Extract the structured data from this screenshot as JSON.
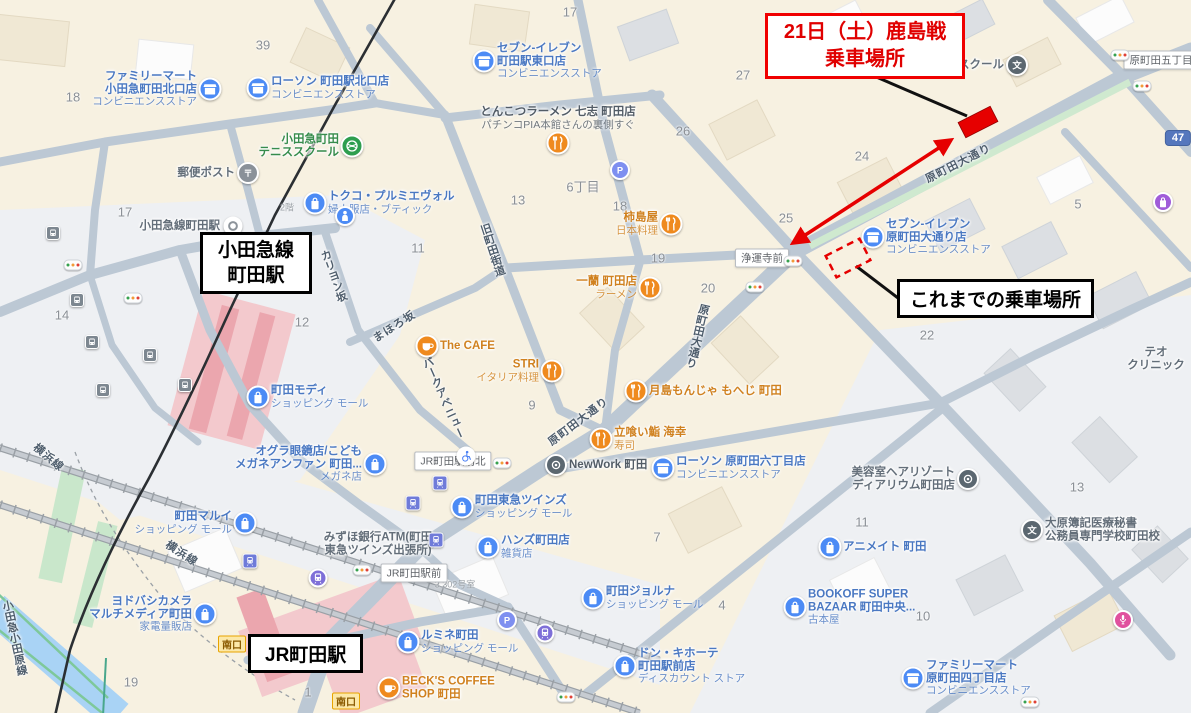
{
  "annotations": {
    "new_boarding": {
      "line1": "21日（土）鹿島戦",
      "line2": "乗車場所"
    },
    "previous_boarding": {
      "label": "これまでの乗車場所"
    },
    "odakyu_box": {
      "line1": "小田急線",
      "line2": "町田駅"
    },
    "jr_box": {
      "label": "JR町田駅"
    },
    "colors": {
      "red": "#e60000",
      "black": "#000000"
    }
  },
  "map": {
    "route_shield": "47",
    "palette": {
      "label_blue": "#4a78c2",
      "label_orange": "#d0811f",
      "label_gray": "#636e79",
      "label_green": "#368c4c",
      "label_dark": "#525c66",
      "poi_blue": "#4c8bf5",
      "poi_orange": "#ef8a1e",
      "poi_green": "#2e9e4f",
      "poi_graymid": "#8a9199",
      "poi_dark": "#5b6770",
      "poi_purple": "#7e6fd8",
      "poi_indigo": "#6f7bd9",
      "poi_busgray": "#7d8790",
      "poi_pblue": "#7e8ff0",
      "poi_pink": "#e0519e",
      "poi_violet": "#a05cd9",
      "poi_white": "#ffffff",
      "road": "#bcc8d4",
      "road_green": "#cfe9cf",
      "water": "#a9d3f5",
      "station_pink": "#f3c9cd",
      "station_pink_dark": "#eba6ae",
      "rail_black": "#2b2f33"
    },
    "intersections": [
      {
        "name": "原町田五丁目",
        "x": 1161,
        "y": 60
      },
      {
        "name": "浄運寺前",
        "x": 762,
        "y": 258
      },
      {
        "name": "JR町田駅前北",
        "x": 453,
        "y": 461
      },
      {
        "name": "JR町田駅前",
        "x": 414,
        "y": 573
      }
    ],
    "gates": {
      "label": "南口",
      "positions": [
        [
          232,
          644
        ],
        [
          346,
          701
        ]
      ]
    },
    "streets": [
      {
        "t": "原町田大通り",
        "x": 958,
        "y": 163,
        "mode": "h",
        "r": -27
      },
      {
        "t": "原町田大通り",
        "x": 697,
        "y": 336,
        "mode": "v",
        "r": 13
      },
      {
        "t": "原町田大通り",
        "x": 578,
        "y": 421,
        "mode": "h",
        "r": -37
      },
      {
        "t": "パークアベニュー",
        "x": 443,
        "y": 398,
        "mode": "v",
        "r": -24
      },
      {
        "t": "まほろ坂",
        "x": 394,
        "y": 326,
        "mode": "h",
        "r": -33
      },
      {
        "t": "旧町田街道",
        "x": 492,
        "y": 250,
        "mode": "v",
        "r": -18
      },
      {
        "t": "カリヨン坂",
        "x": 333,
        "y": 276,
        "mode": "v",
        "r": -20
      },
      {
        "t": "横浜線",
        "x": 49,
        "y": 457,
        "mode": "h",
        "r": 40
      },
      {
        "t": "横浜線",
        "x": 182,
        "y": 553,
        "mode": "h",
        "r": 33
      },
      {
        "t": "小田急小田原線",
        "x": 14,
        "y": 638,
        "mode": "v",
        "r": -12
      }
    ],
    "numbers": [
      {
        "t": "18",
        "x": 73,
        "y": 97
      },
      {
        "t": "39",
        "x": 263,
        "y": 45
      },
      {
        "t": "17",
        "x": 570,
        "y": 12
      },
      {
        "t": "17",
        "x": 125,
        "y": 212
      },
      {
        "t": "27",
        "x": 743,
        "y": 75
      },
      {
        "t": "26",
        "x": 683,
        "y": 131
      },
      {
        "t": "24",
        "x": 862,
        "y": 156
      },
      {
        "t": "25",
        "x": 786,
        "y": 218
      },
      {
        "t": "18",
        "x": 620,
        "y": 206
      },
      {
        "t": "6丁目",
        "x": 583,
        "y": 186
      },
      {
        "t": "13",
        "x": 518,
        "y": 200
      },
      {
        "t": "11",
        "x": 418,
        "y": 248
      },
      {
        "t": "12",
        "x": 302,
        "y": 322
      },
      {
        "t": "19",
        "x": 658,
        "y": 258
      },
      {
        "t": "20",
        "x": 708,
        "y": 288
      },
      {
        "t": "9",
        "x": 532,
        "y": 405
      },
      {
        "t": "22",
        "x": 927,
        "y": 335
      },
      {
        "t": "5",
        "x": 1078,
        "y": 204
      },
      {
        "t": "14",
        "x": 62,
        "y": 315
      },
      {
        "t": "13",
        "x": 1077,
        "y": 487
      },
      {
        "t": "11",
        "x": 862,
        "y": 522
      },
      {
        "t": "10",
        "x": 923,
        "y": 616
      },
      {
        "t": "4",
        "x": 722,
        "y": 605
      },
      {
        "t": "19",
        "x": 131,
        "y": 682
      },
      {
        "t": "7",
        "x": 657,
        "y": 537
      },
      {
        "t": "1",
        "x": 308,
        "y": 692
      }
    ],
    "small_labels": [
      {
        "t": "2階",
        "x": 287,
        "y": 207
      },
      {
        "t": "3 302号室",
        "x": 455,
        "y": 584
      }
    ],
    "pois": [
      {
        "id": "familymart-kitaguchi",
        "x": 210,
        "y": 89,
        "c": "blue",
        "i": "store",
        "side": "l",
        "m": [
          "ファミリーマート",
          "小田急町田北口店"
        ],
        "s": [
          "コンビニエンスストア"
        ]
      },
      {
        "id": "lawson-kitaguchi",
        "x": 258,
        "y": 88,
        "c": "blue",
        "i": "store",
        "side": "r",
        "m": [
          "ローソン 町田駅北口店"
        ],
        "s": [
          "コンビニエンスストア"
        ]
      },
      {
        "id": "seven-higashiguchi",
        "x": 484,
        "y": 61,
        "c": "blue",
        "i": "store",
        "side": "r",
        "m": [
          "セブン-イレブン",
          "町田駅東口店"
        ],
        "s": [
          "コンビニエンスストア"
        ]
      },
      {
        "id": "tennis-school",
        "x": 352,
        "y": 146,
        "c": "green",
        "i": "ball",
        "side": "l",
        "m": [
          "小田急町田",
          "テニススクール"
        ],
        "s": []
      },
      {
        "id": "post-box",
        "x": 248,
        "y": 173,
        "c": "gray",
        "i": "post",
        "side": "l",
        "m": [
          "郵便ポスト"
        ],
        "s": []
      },
      {
        "id": "odakyu-station-name",
        "x": 233,
        "y": 226,
        "c": "gray",
        "i": "station",
        "side": "l",
        "m": [
          "小田急線町田駅"
        ],
        "s": []
      },
      {
        "id": "tokuko",
        "x": 315,
        "y": 203,
        "c": "blue",
        "i": "bag",
        "side": "r",
        "m": [
          "トクコ・プルミエヴォル"
        ],
        "s": [
          "婦人服店・ブティック"
        ]
      },
      {
        "id": "modi",
        "x": 258,
        "y": 397,
        "c": "blue",
        "i": "bag",
        "side": "r",
        "m": [
          "町田モディ"
        ],
        "s": [
          "ショッピング モール"
        ]
      },
      {
        "id": "ogura",
        "x": 375,
        "y": 464,
        "c": "blue",
        "i": "bag",
        "side": "l",
        "m": [
          "オグラ眼鏡店/こども",
          "メガネアンファン 町田..."
        ],
        "s": [
          "メガネ店"
        ]
      },
      {
        "id": "marui",
        "x": 245,
        "y": 523,
        "c": "blue",
        "i": "bag",
        "side": "l",
        "m": [
          "町田マルイ"
        ],
        "s": [
          "ショッピング モール"
        ]
      },
      {
        "id": "yodobashi",
        "x": 205,
        "y": 614,
        "c": "blue",
        "i": "bag",
        "side": "l",
        "m": [
          "ヨドバシカメラ",
          "マルチメディア町田"
        ],
        "s": [
          "家電量販店"
        ]
      },
      {
        "id": "tokyu-twins",
        "x": 462,
        "y": 507,
        "c": "blue",
        "i": "bag",
        "side": "r",
        "m": [
          "町田東急ツインズ"
        ],
        "s": [
          "ショッピング モール"
        ]
      },
      {
        "id": "hands",
        "x": 488,
        "y": 547,
        "c": "blue",
        "i": "bag",
        "side": "r",
        "m": [
          "ハンズ町田店"
        ],
        "s": [
          "雑貨店"
        ]
      },
      {
        "id": "lumine",
        "x": 408,
        "y": 642,
        "c": "blue",
        "i": "bag",
        "side": "r",
        "m": [
          "ルミネ町田"
        ],
        "s": [
          "ショッピング モール"
        ]
      },
      {
        "id": "jorna",
        "x": 593,
        "y": 598,
        "c": "blue",
        "i": "bag",
        "side": "r",
        "m": [
          "町田ジョルナ"
        ],
        "s": [
          "ショッピング モール"
        ]
      },
      {
        "id": "donki",
        "x": 625,
        "y": 666,
        "c": "blue",
        "i": "bag",
        "side": "r",
        "m": [
          "ドン・キホーテ",
          "町田駅前店"
        ],
        "s": [
          "ディスカウント ストア"
        ]
      },
      {
        "id": "bookoff",
        "x": 795,
        "y": 607,
        "c": "blue",
        "i": "bag",
        "side": "r",
        "m": [
          "BOOKOFF SUPER",
          "BAZAAR 町田中央..."
        ],
        "s": [
          "古本屋"
        ]
      },
      {
        "id": "animate",
        "x": 830,
        "y": 547,
        "c": "blue",
        "i": "bag",
        "side": "r",
        "m": [
          "アニメイト 町田"
        ],
        "s": []
      },
      {
        "id": "lawson-6chome",
        "x": 663,
        "y": 468,
        "c": "blue",
        "i": "store",
        "side": "r",
        "m": [
          "ローソン 原町田六丁目店"
        ],
        "s": [
          "コンビニエンスストア"
        ]
      },
      {
        "id": "familymart-4chome",
        "x": 913,
        "y": 678,
        "c": "blue",
        "i": "store",
        "side": "r",
        "m": [
          "ファミリーマート",
          "原町田四丁目店"
        ],
        "s": [
          "コンビニエンスストア"
        ]
      },
      {
        "id": "seven-odori",
        "x": 873,
        "y": 237,
        "c": "blue",
        "i": "store",
        "side": "r",
        "m": [
          "セブン-イレブン",
          "原町田大通り店"
        ],
        "s": [
          "コンビニエンスストア"
        ]
      },
      {
        "id": "tonkotsu-nanashi",
        "x": 558,
        "y": 143,
        "c": "dark",
        "i": "rest",
        "side": "a",
        "m": [
          "とんこつラーメン 七志 町田店"
        ],
        "s": [
          "パチンコPIA本館さんの裏側すぐ"
        ]
      },
      {
        "id": "kakishimaya",
        "x": 671,
        "y": 224,
        "c": "orange",
        "i": "rest",
        "side": "l",
        "m": [
          "柿島屋"
        ],
        "s": [
          "日本料理"
        ]
      },
      {
        "id": "ichiran",
        "x": 650,
        "y": 288,
        "c": "orange",
        "i": "rest",
        "side": "l",
        "m": [
          "一蘭 町田店"
        ],
        "s": [
          "ラーメン"
        ]
      },
      {
        "id": "the-cafe",
        "x": 427,
        "y": 346,
        "c": "orange",
        "i": "cafe",
        "side": "r",
        "m": [
          "The CAFE"
        ],
        "s": []
      },
      {
        "id": "stri",
        "x": 552,
        "y": 371,
        "c": "orange",
        "i": "rest",
        "side": "l",
        "m": [
          "STRI"
        ],
        "s": [
          "イタリア料理"
        ]
      },
      {
        "id": "tsukishima-moheji",
        "x": 636,
        "y": 391,
        "c": "orange",
        "i": "rest",
        "side": "r",
        "m": [
          "月島もんじゃ もへじ 町田"
        ],
        "s": []
      },
      {
        "id": "sushi-kaiko",
        "x": 601,
        "y": 439,
        "c": "orange",
        "i": "rest",
        "side": "r",
        "m": [
          "立喰い鮨 海幸"
        ],
        "s": [
          "寿司"
        ]
      },
      {
        "id": "becks-coffee",
        "x": 389,
        "y": 688,
        "c": "orange",
        "i": "cafe",
        "side": "r",
        "m": [
          "BECK'S COFFEE",
          "SHOP 町田"
        ],
        "s": []
      },
      {
        "id": "newwork",
        "x": 556,
        "y": 465,
        "c": "dark",
        "i": "dot",
        "side": "r",
        "m": [
          "NewWork 町田"
        ],
        "s": []
      },
      {
        "id": "mizuho-atm",
        "x": 378,
        "y": 544,
        "c": "gray",
        "i": "none",
        "side": "n",
        "m": [
          "みずほ銀行ATM(町田",
          "東急ツインズ出張所)"
        ],
        "s": []
      },
      {
        "id": "hair-diarium",
        "x": 968,
        "y": 479,
        "c": "gray",
        "i": "dot",
        "side": "l",
        "m": [
          "美容室ヘアリゾート",
          "ディアリウム町田店"
        ],
        "s": []
      },
      {
        "id": "ohara-gakko",
        "x": 1032,
        "y": 530,
        "c": "gray",
        "i": "school",
        "side": "r",
        "m": [
          "大原簿記医療秘書",
          "公務員専門学校町田校"
        ],
        "s": []
      },
      {
        "id": "theo-clinic",
        "x": 1156,
        "y": 359,
        "c": "gray",
        "i": "none",
        "side": "n",
        "m": [
          "テオ",
          "クリニック"
        ],
        "s": []
      },
      {
        "id": "school-top",
        "x": 1017,
        "y": 65,
        "c": "gray",
        "i": "school",
        "side": "l",
        "m": [
          "スクール"
        ],
        "s": []
      },
      {
        "id": "karaoke",
        "x": 1123,
        "y": 620,
        "i": "mic"
      },
      {
        "id": "purple-shop",
        "x": 1163,
        "y": 202,
        "i": "shop"
      },
      {
        "id": "parking-6chome",
        "x": 620,
        "y": 170,
        "i": "p"
      },
      {
        "id": "parking-twins",
        "x": 507,
        "y": 620,
        "i": "p"
      },
      {
        "id": "toilet",
        "x": 345,
        "y": 216,
        "i": "person"
      },
      {
        "id": "wheelchair-access",
        "x": 466,
        "y": 456,
        "i": "wheel"
      },
      {
        "id": "metro-entrance-1",
        "x": 318,
        "y": 578,
        "i": "train"
      },
      {
        "id": "metro-entrance-2",
        "x": 545,
        "y": 633,
        "i": "train"
      },
      {
        "id": "station-entrance-1",
        "x": 436,
        "y": 540,
        "i": "trainsq"
      },
      {
        "id": "station-entrance-2",
        "x": 250,
        "y": 561,
        "i": "trainsq"
      },
      {
        "id": "station-entrance-3",
        "x": 440,
        "y": 483,
        "i": "trainsq"
      },
      {
        "id": "station-entrance-4",
        "x": 413,
        "y": 503,
        "i": "trainsq"
      }
    ],
    "bus_stops": [
      [
        53,
        233
      ],
      [
        77,
        300
      ],
      [
        92,
        342
      ],
      [
        103,
        390
      ],
      [
        150,
        355
      ],
      [
        185,
        385
      ]
    ],
    "traffic_lights": [
      [
        73,
        265
      ],
      [
        133,
        298
      ],
      [
        1120,
        55
      ],
      [
        1142,
        86
      ],
      [
        793,
        261
      ],
      [
        755,
        287
      ],
      [
        502,
        463
      ],
      [
        362,
        570
      ],
      [
        566,
        697
      ],
      [
        1030,
        702
      ]
    ]
  }
}
